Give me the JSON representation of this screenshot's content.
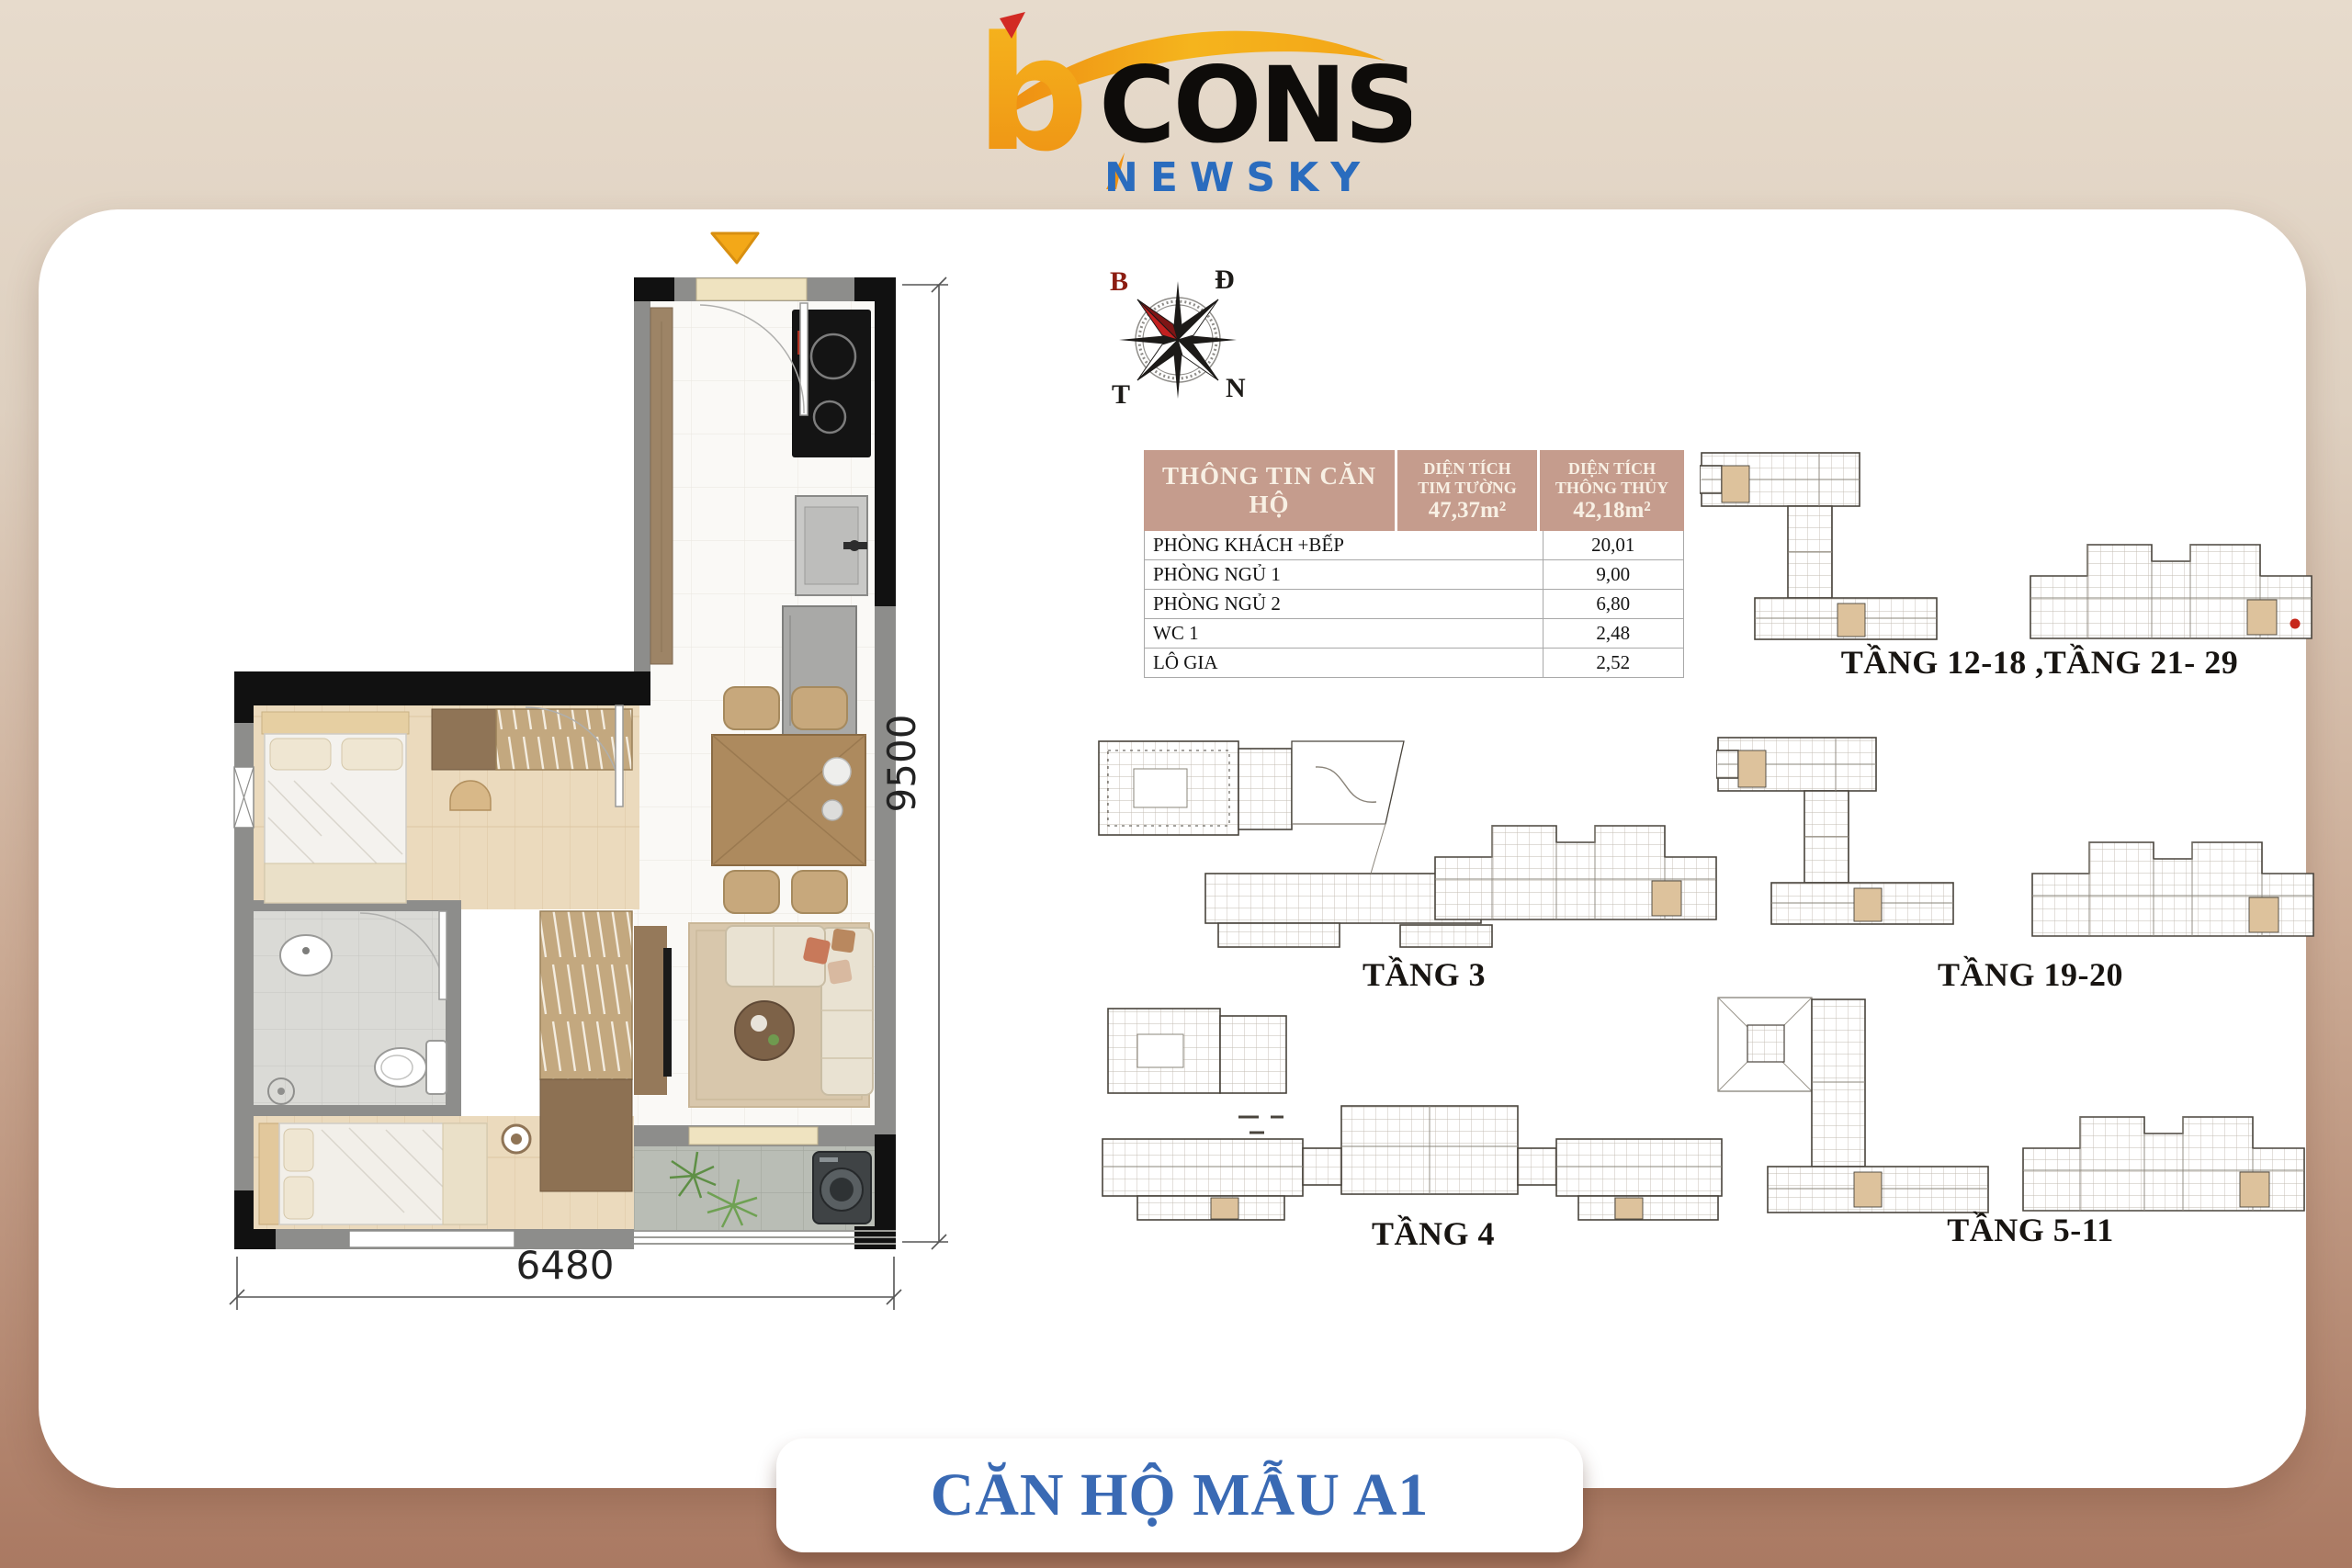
{
  "logo": {
    "b": "b",
    "cons": "CONS",
    "newsky": "NEWSKY"
  },
  "compass": {
    "north": "B",
    "east": "Đ",
    "west": "T",
    "south": "N"
  },
  "info_table": {
    "title": "THÔNG TIN CĂN HỘ",
    "columns": [
      {
        "label_line1": "DIỆN TÍCH",
        "label_line2": "TIM TƯỜNG",
        "value": "47,37m²"
      },
      {
        "label_line1": "DIỆN TÍCH",
        "label_line2": "THÔNG THỦY",
        "value": "42,18m²"
      }
    ],
    "rows": [
      {
        "label": "PHÒNG KHÁCH +BẾP",
        "value": "20,01"
      },
      {
        "label": "PHÒNG NGỦ 1",
        "value": "9,00"
      },
      {
        "label": "PHÒNG NGỦ 2",
        "value": "6,80"
      },
      {
        "label": "WC 1",
        "value": "2,48"
      },
      {
        "label": "LÔ GIA",
        "value": "2,52"
      }
    ]
  },
  "plan": {
    "width_dim": "6480",
    "height_dim": "9500"
  },
  "plates": [
    {
      "label": "TẦNG 12-18 ,TẦNG 21- 29"
    },
    {
      "label": "TẦNG 3"
    },
    {
      "label": "TẦNG 19-20"
    },
    {
      "label": "TẦNG 4"
    },
    {
      "label": "TẦNG 5-11"
    }
  ],
  "footer": {
    "title": "CĂN HỘ MẪU A1"
  },
  "colors": {
    "accent_blue": "#3a6ab4",
    "table_header": "#c59c8d",
    "unit_highlight": "#ddc29c",
    "entry_marker": "#f3a818",
    "background_top": "#e7dbcc",
    "background_bottom": "#aa7962"
  }
}
